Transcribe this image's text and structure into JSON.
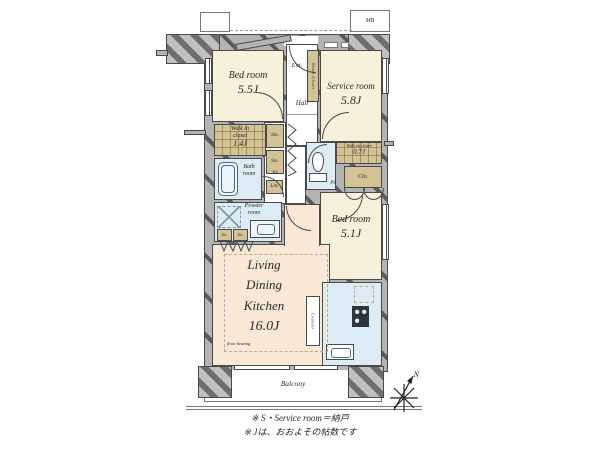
{
  "rooms": {
    "bedroom_top": {
      "name": "Bed room",
      "size": "5.5J"
    },
    "service": {
      "name": "Service room",
      "size": "5.8J"
    },
    "bedroom_right": {
      "name": "Bed room",
      "size": "5.1J"
    },
    "ldk": {
      "lines": [
        "Living",
        "Dining",
        "Kitchen"
      ],
      "size": "16.0J",
      "floor_note": "floor heating"
    },
    "bath": {
      "lines": [
        "Bath",
        "room"
      ]
    },
    "powder": {
      "lines": [
        "Powder",
        "room"
      ]
    },
    "hall": "Hall",
    "entrance": "Ent.",
    "balcony": "Balcony"
  },
  "closets": {
    "shoes_closet": "Shoes Closet",
    "wic_main": {
      "lines": [
        "Walk in",
        "closet"
      ],
      "size": "1.4J"
    },
    "wic_small": {
      "name": "Walk in closet",
      "size": "0.7J"
    },
    "closet": "Clo.",
    "linen": "Lin.",
    "storage": "Sto.",
    "pipe_space": "PS",
    "meter_box": "MB",
    "counter": "Counter"
  },
  "compass": {
    "north": "N"
  },
  "notes": {
    "line1": "※ S・Service room＝納戸",
    "line2": "※ Jは、おおよその帖数です"
  },
  "colors": {
    "room_cream": "#f5f1da",
    "ldk_peach": "#f8e8d5",
    "wet_blue": "#dcebf4",
    "closet_tan": "#d3c295",
    "wall_gray": "#b3b3b3"
  }
}
